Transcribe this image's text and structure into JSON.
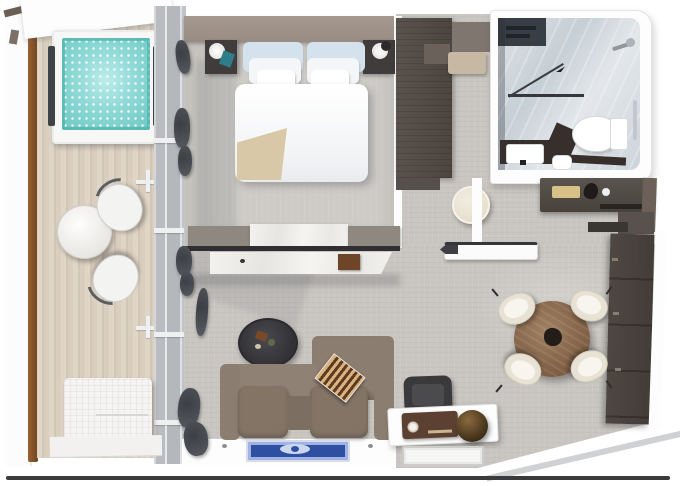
{
  "title": "suite-floor-plan",
  "palette": {
    "water": "#8fd9d6",
    "rail_wood": "#9a6233",
    "accent_wall": "#a5988e",
    "sofa": "#8b7d70",
    "entry_floor": "#473a31",
    "dining_table": "#8a6a4e",
    "rug_blue": "#2f4fa0",
    "dark_furniture": "#4e4842",
    "bath_marble": "#ccd3d8",
    "radio_brown": "#5c4132"
  },
  "rooms": [
    {
      "name": "balcony",
      "furniture": [
        "whirlpool-tub",
        "outdoor-table",
        "outdoor-chair",
        "outdoor-chair",
        "sun-lounger"
      ]
    },
    {
      "name": "bedroom",
      "furniture": [
        "double-bed",
        "nightstand-left",
        "nightstand-right",
        "bedside-lamp",
        "bedside-lamp",
        "vanity-divider"
      ]
    },
    {
      "name": "walk-in-closet",
      "furniture": [
        "wardrobe",
        "bench",
        "stool"
      ]
    },
    {
      "name": "bathroom",
      "furniture": [
        "shower",
        "shower-glass",
        "toilet",
        "vanity-sink",
        "towel-bar"
      ]
    },
    {
      "name": "living-room",
      "furniture": [
        "sofa",
        "backgammon-board",
        "coffee-table",
        "desk",
        "desk-chair",
        "radio",
        "decor-sphere",
        "rug"
      ]
    },
    {
      "name": "dining-area",
      "furniture": [
        "round-dining-table",
        "dining-chair",
        "dining-chair",
        "dining-chair",
        "dining-chair",
        "shelving-cabinet",
        "minibar-console"
      ]
    },
    {
      "name": "entry",
      "furniture": [
        "entry-door",
        "door-mat-floor"
      ]
    }
  ]
}
